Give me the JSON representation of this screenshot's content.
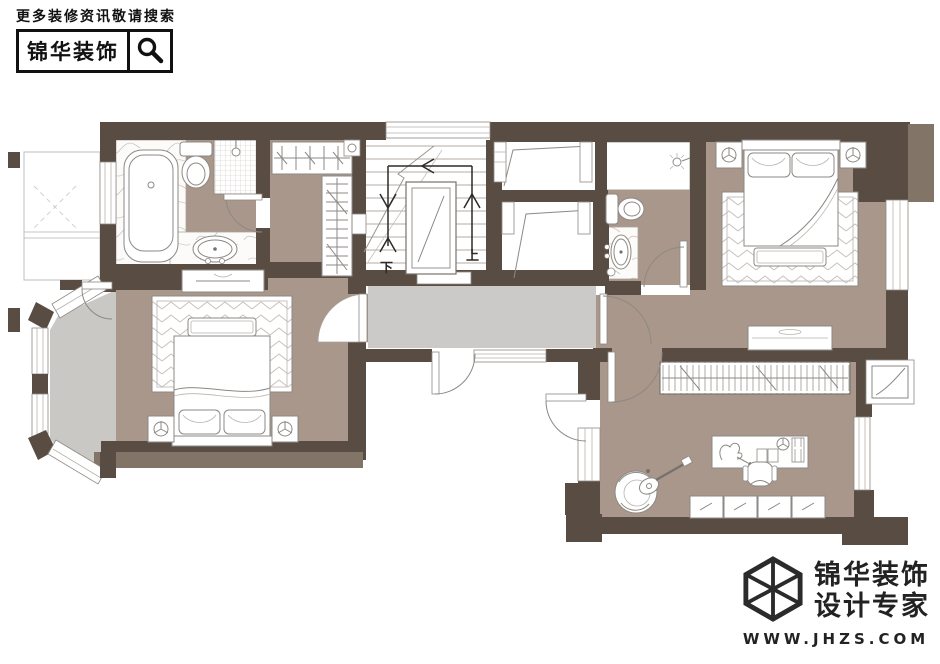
{
  "header": {
    "tagline": "更多装修资讯敬请搜索",
    "brand": "锦华装饰",
    "search_icon": "magnifier-icon"
  },
  "footer": {
    "brand": "锦华装饰",
    "subtitle": "设计专家",
    "website": "WWW.JHZS.COM",
    "logo_icon": "cube-wireframe-icon"
  },
  "floor_plan": {
    "stair_up_label": "上",
    "stair_down_label": "下",
    "colors": {
      "wall_dark": "#594d43",
      "wall_light": "#837468",
      "room_floor": "#a8978a",
      "hallway_floor": "#cbcac8",
      "bay_floor": "#c9c8c5",
      "furniture_line": "#8d8984",
      "background": "#ffffff"
    }
  }
}
